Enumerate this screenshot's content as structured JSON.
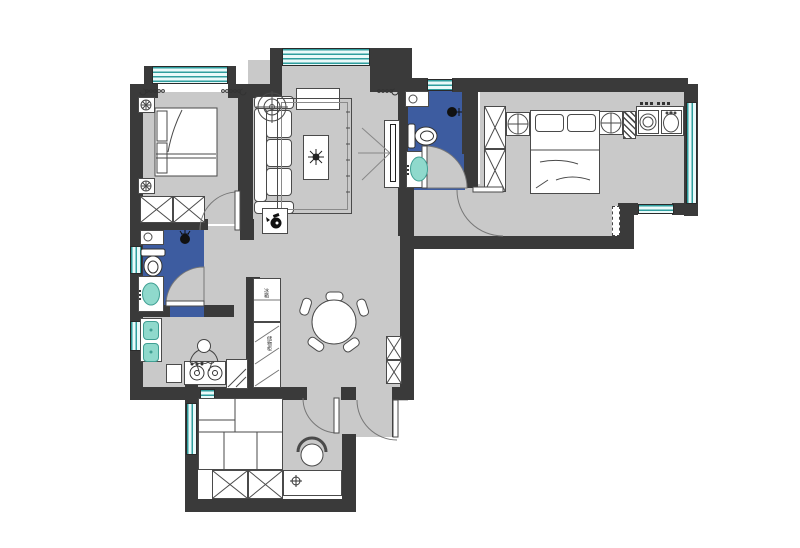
{
  "title": "apartment-floor-plan",
  "colors": {
    "wall": "#3a3a3a",
    "floor": "#c9c9c9",
    "bath_blue": "#3d5ca0",
    "window_line": "#2f9e9e",
    "window_fill": "#eafafa",
    "basin_teal": "#8fd9cc",
    "line": "#4a4a4a"
  },
  "labels": {
    "fridge": "冰箱",
    "tall_cabinet": "储物柜"
  },
  "rooms": [
    {
      "id": "bedroom-top-left",
      "furniture": [
        "double-bed",
        "nightstand",
        "nightstand",
        "wardrobe",
        "curtain",
        "window"
      ]
    },
    {
      "id": "living-room",
      "furniture": [
        "sofa",
        "fan",
        "tv-cabinet",
        "rug",
        "coffee-table-plant",
        "tv-partition",
        "kettle-table",
        "curtain",
        "window"
      ]
    },
    {
      "id": "bathroom-left",
      "furniture": [
        "toilet",
        "washbasin",
        "shower-head",
        "cabinet",
        "window"
      ]
    },
    {
      "id": "kitchen-left",
      "furniture": [
        "double-sink",
        "gas-hob",
        "cook-figure",
        "stool",
        "corner-counter",
        "window"
      ]
    },
    {
      "id": "dining-area",
      "furniture": [
        "round-table",
        "chairs-x5",
        "fridge",
        "tall-cabinet",
        "wall-cabinet"
      ]
    },
    {
      "id": "ensuite-bathroom",
      "furniture": [
        "toilet",
        "washbasin",
        "shower-head",
        "cabinet",
        "window"
      ]
    },
    {
      "id": "master-bedroom",
      "furniture": [
        "double-bed",
        "wardrobe",
        "round-nightstand",
        "round-nightstand",
        "threshold"
      ]
    },
    {
      "id": "laundry-kitchenette",
      "furniture": [
        "counter",
        "washing-machine",
        "laundry-sink",
        "hatched-column",
        "window"
      ]
    },
    {
      "id": "study-bedroom-bottom",
      "furniture": [
        "tatami-bed",
        "wardrobe",
        "desk",
        "chair",
        "desk-lamp",
        "window"
      ]
    }
  ]
}
